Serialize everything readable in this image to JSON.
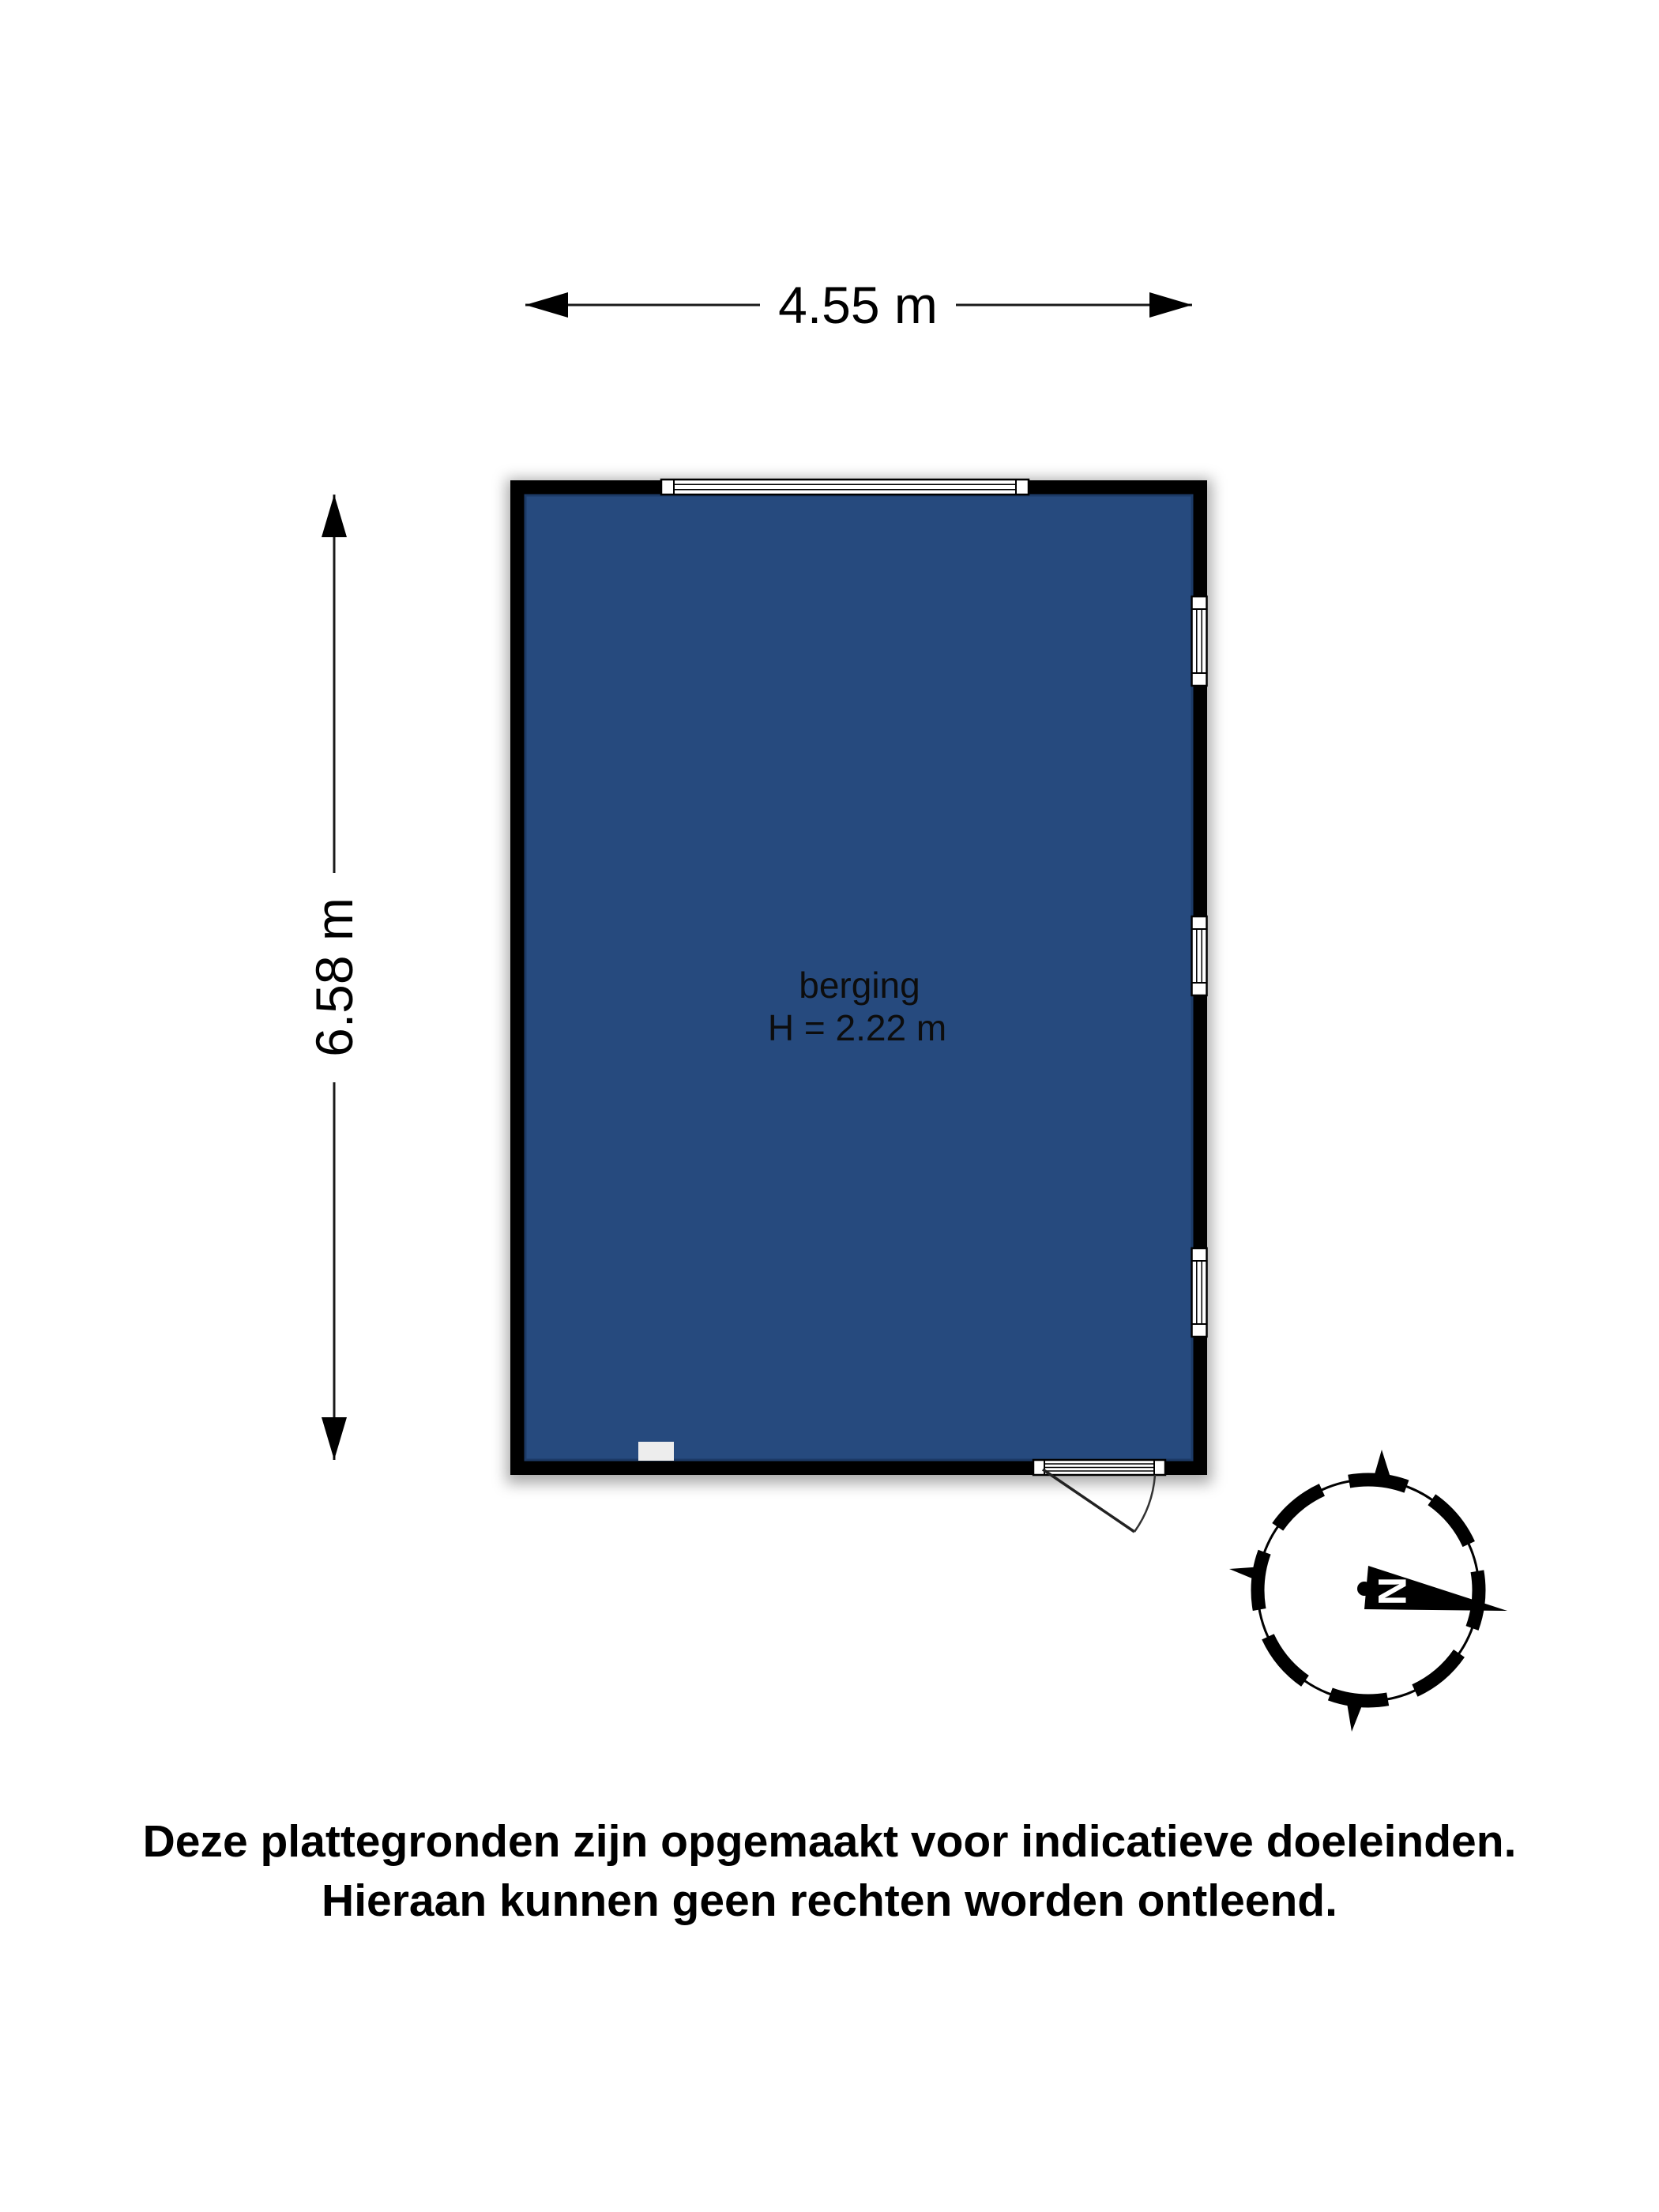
{
  "plan": {
    "room": {
      "name": "berging",
      "ceiling_height_label": "H = 2.22 m"
    },
    "dimensions": {
      "width_label": "4.55 m",
      "height_label": "6.58 m"
    },
    "compass": {
      "north_label": "N"
    },
    "disclaimer": {
      "line1": "Deze plattegronden zijn opgemaakt voor indicatieve doeleinden.",
      "line2": "Hieraan kunnen geen rechten worden ontleend."
    },
    "colors": {
      "wall": "#000000",
      "floor": "#264a7e",
      "floor_border": "#1c3a66",
      "window_fill": "#ffffff",
      "fixture": "#ededed"
    }
  }
}
